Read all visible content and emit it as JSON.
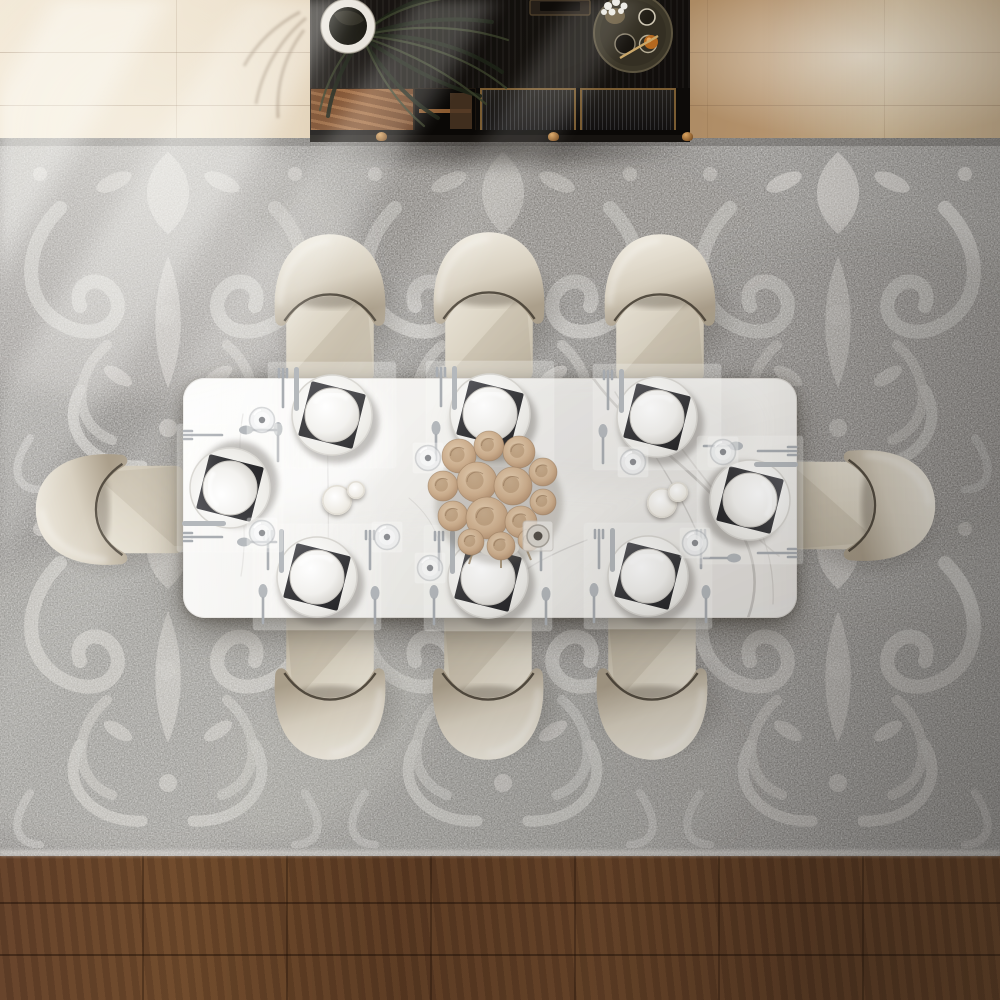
{
  "scene": {
    "title": "dining-room-top-view",
    "description": "Bird's-eye 3D render of a rectangular white marble dining table with eight cream leather barrel chairs on a gray damask area rug, dark wood sideboard with potted palm and serving tray at top, wood flooring with diagonal window light",
    "palette": {
      "floor_light_wood": "#ecdfc9",
      "floor_mid_wood": "#b3916b",
      "floor_dark_wood": "#63412a",
      "rug_base": "#8e8c89",
      "rug_motif": "#c7c5c1",
      "marble": "#f4f3f1",
      "marble_vein": "#b5b2ae",
      "chair_seat": "#d5cdbd",
      "chair_back": "#ece7dc",
      "chair_seam": "#413a2f",
      "sideboard_black": "#14110e",
      "sideboard_wood_door": "#8a5229",
      "brass": "#b58443",
      "napkin_dark": "#3c3c3e",
      "dinnerware_white": "#f5f4f1",
      "flowers_beige": "#c9ab8c"
    },
    "table": {
      "x": 183,
      "y": 378,
      "width": 614,
      "height": 240,
      "material": "white marble",
      "corner_radius": 22
    },
    "chairs": [
      {
        "name": "chair-top-left",
        "x": 264,
        "y": 227,
        "rot": 0
      },
      {
        "name": "chair-top-middle",
        "x": 423,
        "y": 225,
        "rot": 0
      },
      {
        "name": "chair-top-right",
        "x": 594,
        "y": 227,
        "rot": 0
      },
      {
        "name": "chair-bottom-left",
        "x": 264,
        "y": 612,
        "rot": 180
      },
      {
        "name": "chair-bottom-middle",
        "x": 422,
        "y": 612,
        "rot": 180
      },
      {
        "name": "chair-bottom-right",
        "x": 586,
        "y": 612,
        "rot": 180
      },
      {
        "name": "chair-left-end",
        "x": 40,
        "y": 432,
        "rot": -90
      },
      {
        "name": "chair-right-end",
        "x": 799,
        "y": 428,
        "rot": 90
      }
    ],
    "place_settings": [
      {
        "name": "setting-top-left",
        "x": 332,
        "y": 415,
        "rot": 0,
        "double": false
      },
      {
        "name": "setting-top-middle",
        "x": 490,
        "y": 414,
        "rot": 0,
        "double": false
      },
      {
        "name": "setting-top-right",
        "x": 657,
        "y": 417,
        "rot": 0,
        "double": false
      },
      {
        "name": "setting-bottom-left",
        "x": 317,
        "y": 577,
        "rot": 0,
        "double": true
      },
      {
        "name": "setting-bottom-middle",
        "x": 488,
        "y": 578,
        "rot": 0,
        "double": true
      },
      {
        "name": "setting-bottom-right",
        "x": 648,
        "y": 576,
        "rot": 0,
        "double": true
      },
      {
        "name": "setting-left-end",
        "x": 230,
        "y": 488,
        "rot": -90,
        "double": true
      },
      {
        "name": "setting-right-end",
        "x": 750,
        "y": 500,
        "rot": 90,
        "double": true
      }
    ],
    "glasses": [
      {
        "x": 262,
        "y": 420
      },
      {
        "x": 428,
        "y": 458
      },
      {
        "x": 633,
        "y": 462
      },
      {
        "x": 262,
        "y": 533
      },
      {
        "x": 387,
        "y": 537
      },
      {
        "x": 430,
        "y": 568
      },
      {
        "x": 695,
        "y": 543
      },
      {
        "x": 723,
        "y": 452
      }
    ],
    "candles": [
      {
        "x": 337,
        "y": 500,
        "r": 15
      },
      {
        "x": 356,
        "y": 490,
        "r": 9
      },
      {
        "x": 662,
        "y": 503,
        "r": 15
      },
      {
        "x": 678,
        "y": 492,
        "r": 10
      }
    ],
    "centerpiece": {
      "x": 497,
      "y": 500,
      "type": "dried beige rose bouquet",
      "blooms": [
        {
          "dx": -38,
          "dy": -44,
          "r": 17
        },
        {
          "dx": -8,
          "dy": -54,
          "r": 15
        },
        {
          "dx": 22,
          "dy": -48,
          "r": 16
        },
        {
          "dx": 46,
          "dy": -28,
          "r": 14
        },
        {
          "dx": -54,
          "dy": -14,
          "r": 15
        },
        {
          "dx": -20,
          "dy": -18,
          "r": 20
        },
        {
          "dx": 16,
          "dy": -14,
          "r": 19
        },
        {
          "dx": 46,
          "dy": 2,
          "r": 13
        },
        {
          "dx": -44,
          "dy": 16,
          "r": 15
        },
        {
          "dx": -10,
          "dy": 18,
          "r": 21
        },
        {
          "dx": 24,
          "dy": 22,
          "r": 16
        },
        {
          "dx": -26,
          "dy": 42,
          "r": 13
        },
        {
          "dx": 4,
          "dy": 46,
          "r": 14
        },
        {
          "dx": 32,
          "dy": 40,
          "r": 11
        }
      ],
      "votive": {
        "x": 537,
        "y": 535
      }
    },
    "sideboard": {
      "x": 310,
      "y": 0,
      "width": 380,
      "height": 142,
      "legs_x": [
        66,
        238,
        372
      ],
      "items": [
        "potted-palm-plant",
        "decor-box",
        "round-serving-tray",
        "white-flower-vase",
        "amber-decanter",
        "glassware"
      ]
    },
    "chair_shadow_offset": {
      "dx": 8,
      "dy": 12
    }
  }
}
